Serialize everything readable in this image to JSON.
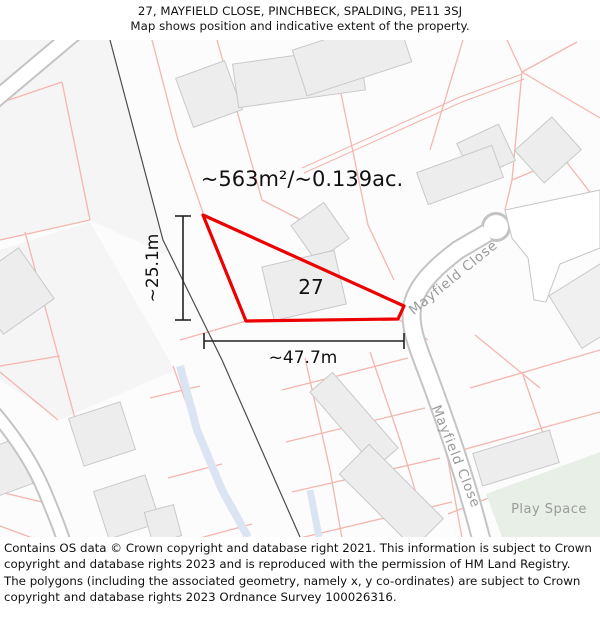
{
  "header": {
    "title": "27, MAYFIELD CLOSE, PINCHBECK, SPALDING, PE11 3SJ",
    "subtitle": "Map shows position and indicative extent of the property."
  },
  "map": {
    "area_label": "~563m²/~0.139ac.",
    "plot_number": "27",
    "width_label": "~47.7m",
    "height_label": "~25.1m",
    "street_labels": [
      "Mayfield Close",
      "Mayfield Close"
    ],
    "green_space_label": "Play Space"
  },
  "footer": {
    "attribution": "Contains OS data © Crown copyright and database right 2021. This information is subject to Crown copyright and database rights 2023 and is reproduced with the permission of HM Land Registry. The polygons (including the associated geometry, namely x, y co-ordinates) are subject to Crown copyright and database rights 2023 Ordnance Survey 100026316."
  },
  "theme": {
    "highlight_red": "#ec0000",
    "parcel_pink": "#f5b5ae",
    "building_fill": "#ededed",
    "building_stroke": "#c9c9c9",
    "road_casing": "#c4c4c4",
    "road_fill": "#ffffff",
    "water_blue": "#dbe4f3",
    "green_space": "#e8efe7",
    "boundary_dark": "#4d4d4d",
    "label_gray": "#9a9a9a"
  }
}
